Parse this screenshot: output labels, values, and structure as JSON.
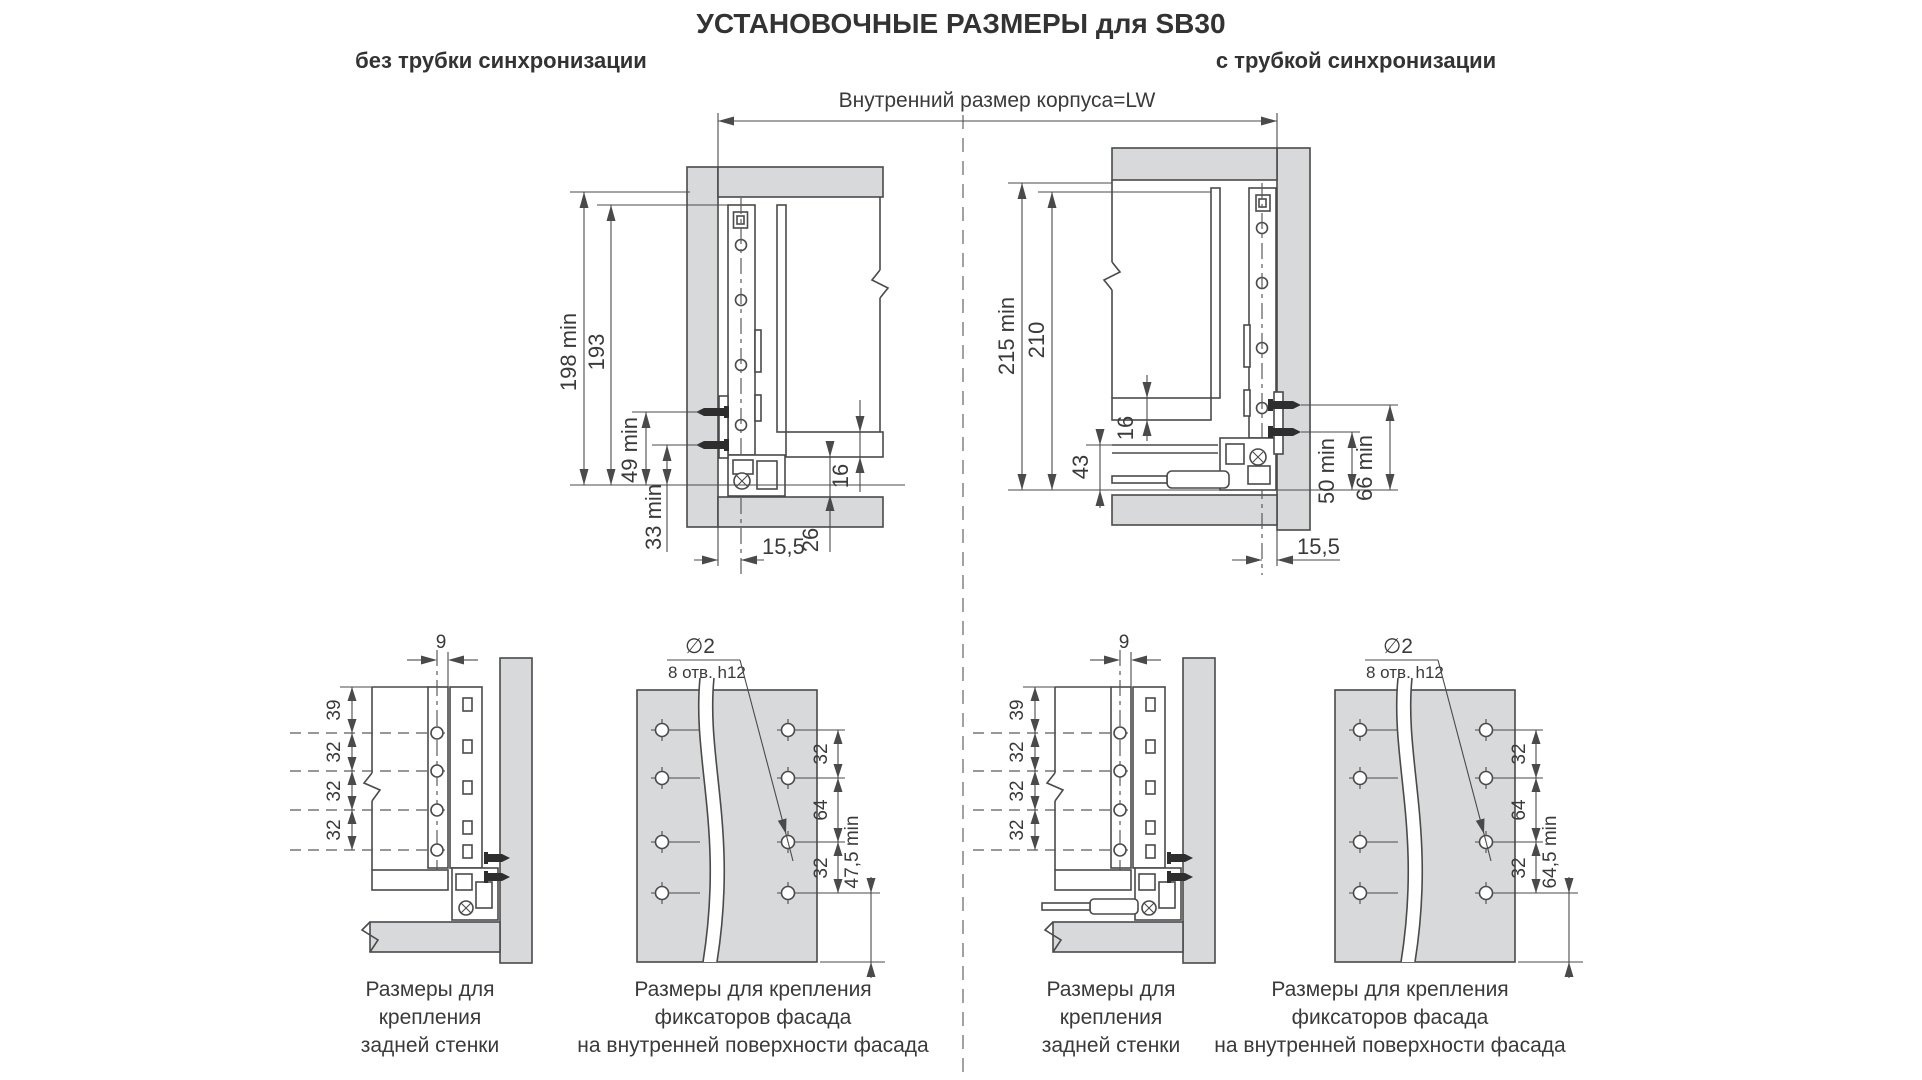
{
  "title": "УСТАНОВОЧНЫЕ РАЗМЕРЫ для SB30",
  "headers": {
    "left": "без трубки синхронизации",
    "right": "с трубкой синхронизации"
  },
  "lw_label": "Внутренний размер корпуса=LW",
  "colors": {
    "panel": "#d8d9da",
    "line": "#4a4a4a",
    "text": "#3a3a3a"
  },
  "top_left": {
    "dims": {
      "total": "198 min",
      "rail": "193",
      "screw_upper": "49 min",
      "screw_lower": "33 min",
      "bottom": "16",
      "gap": "26",
      "offset": "15,5"
    }
  },
  "top_right": {
    "dims": {
      "total": "215 min",
      "rail": "210",
      "bottom": "16",
      "tube": "43",
      "screw_lower": "50 min",
      "screw_upper": "66 min",
      "offset": "15,5"
    }
  },
  "back_left": {
    "dims": {
      "offset": "9",
      "first": "39",
      "p1": "32",
      "p2": "32",
      "p3": "32"
    },
    "caption": [
      "Размеры для",
      "крепления",
      "задней стенки"
    ]
  },
  "facade_left": {
    "hole": "∅2",
    "note": "8 отв. h12",
    "dims": {
      "p1": "32",
      "p2": "64",
      "p3": "32",
      "bottom": "47,5 min"
    },
    "caption": [
      "Размеры для крепления",
      "фиксаторов фасада",
      "на внутренней поверхности фасада"
    ]
  },
  "back_right": {
    "dims": {
      "offset": "9",
      "first": "39",
      "p1": "32",
      "p2": "32",
      "p3": "32"
    },
    "caption": [
      "Размеры для",
      "крепления",
      "задней стенки"
    ]
  },
  "facade_right": {
    "hole": "∅2",
    "note": "8 отв. h12",
    "dims": {
      "p1": "32",
      "p2": "64",
      "p3": "32",
      "bottom": "64,5 min"
    },
    "caption": [
      "Размеры для крепления",
      "фиксаторов фасада",
      "на внутренней поверхности фасада"
    ]
  }
}
